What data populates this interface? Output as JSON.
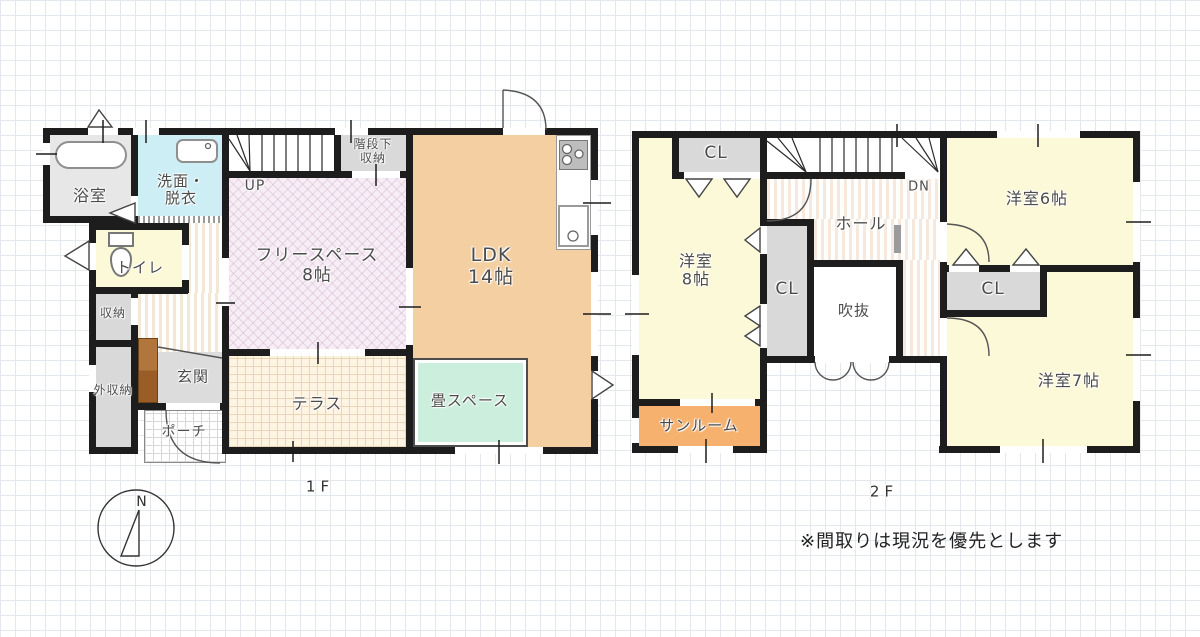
{
  "floor1": {
    "floor_label": "1F",
    "bath": "浴室",
    "washroom": "洗面・\n脱衣",
    "toilet": "トイレ",
    "storage": "収納",
    "outside_storage": "外収納",
    "entrance": "玄関",
    "porch": "ポーチ",
    "under_stair_storage": "階段下\n収納",
    "up": "UP",
    "free_space": "フリースペース\n8帖",
    "ldk": "LDK\n14帖",
    "terrace": "テラス",
    "tatami_space": "畳スペース"
  },
  "floor2": {
    "floor_label": "2F",
    "closet1": "CL",
    "closet2": "CL",
    "closet3": "CL",
    "down": "DN",
    "hall": "ホール",
    "atrium": "吹抜",
    "western_room_8": "洋室\n8帖",
    "western_room_6": "洋室6帖",
    "western_room_7": "洋室7帖",
    "sunroom": "サンルーム"
  },
  "note": "※間取りは現況を優先とします",
  "compass_north": "N",
  "colors": {
    "wall": "#1d1d1d",
    "grid_line": "#e3e7ee",
    "room_yellow": "#fcf9d8",
    "room_gray": "#d9d9d9",
    "bath_gray": "#e7e7e7",
    "washroom_cyan": "#cdeef5",
    "free_space_pink": "#f7edf5",
    "ldk_peach": "#f4cfa1",
    "tatami_mint": "#ccefdd",
    "terrace_cream": "#fdf4e2",
    "sunroom_orange": "#f5b16d",
    "hall_stripe": "#f3e7d5",
    "cabinet_brown": "#a96a31",
    "label_text": "#4c4c4c"
  }
}
